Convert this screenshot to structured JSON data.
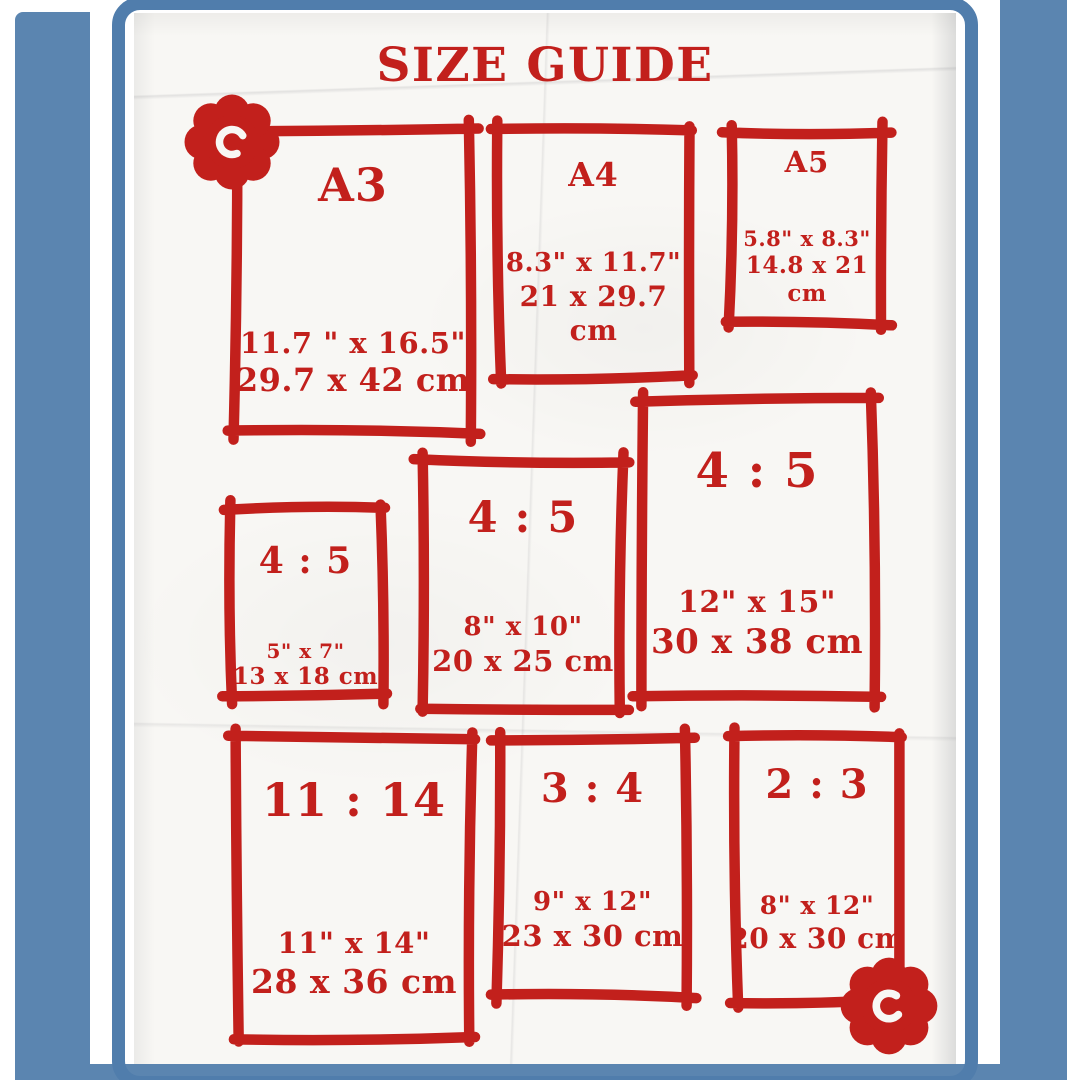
{
  "title": "SIZE GUIDE",
  "colors": {
    "red": "#c2201c",
    "mat_blue": "#5b85b0",
    "frame_blue": "#507dac",
    "paper": "#f8f7f4"
  },
  "icons": {
    "top_left": "flower-icon",
    "bottom_right": "flower-icon"
  },
  "boxes": [
    {
      "id": "a3",
      "label": "A3",
      "inches": "11.7 \" x 16.5\"",
      "cm": "29.7 x 42 cm"
    },
    {
      "id": "a4",
      "label": "A4",
      "inches": "8.3\" x 11.7\"",
      "cm": "21 x 29.7 cm"
    },
    {
      "id": "a5",
      "label": "A5",
      "inches": "5.8\" x 8.3\"",
      "cm": "14.8 x 21 cm"
    },
    {
      "id": "4-5-small",
      "label": "4 : 5",
      "inches": "5\" x 7\"",
      "cm": "13 x 18 cm"
    },
    {
      "id": "4-5-mid",
      "label": "4 : 5",
      "inches": "8\" x 10\"",
      "cm": "20 x 25 cm"
    },
    {
      "id": "4-5-large",
      "label": "4 : 5",
      "inches": "12\" x 15\"",
      "cm": "30 x 38 cm"
    },
    {
      "id": "11-14",
      "label": "11 : 14",
      "inches": "11\" x 14\"",
      "cm": "28 x 36 cm"
    },
    {
      "id": "3-4",
      "label": "3 : 4",
      "inches": "9\" x 12\"",
      "cm": "23 x 30 cm"
    },
    {
      "id": "2-3",
      "label": "2 : 3",
      "inches": "8\" x 12\"",
      "cm": "20 x 30 cm"
    }
  ]
}
